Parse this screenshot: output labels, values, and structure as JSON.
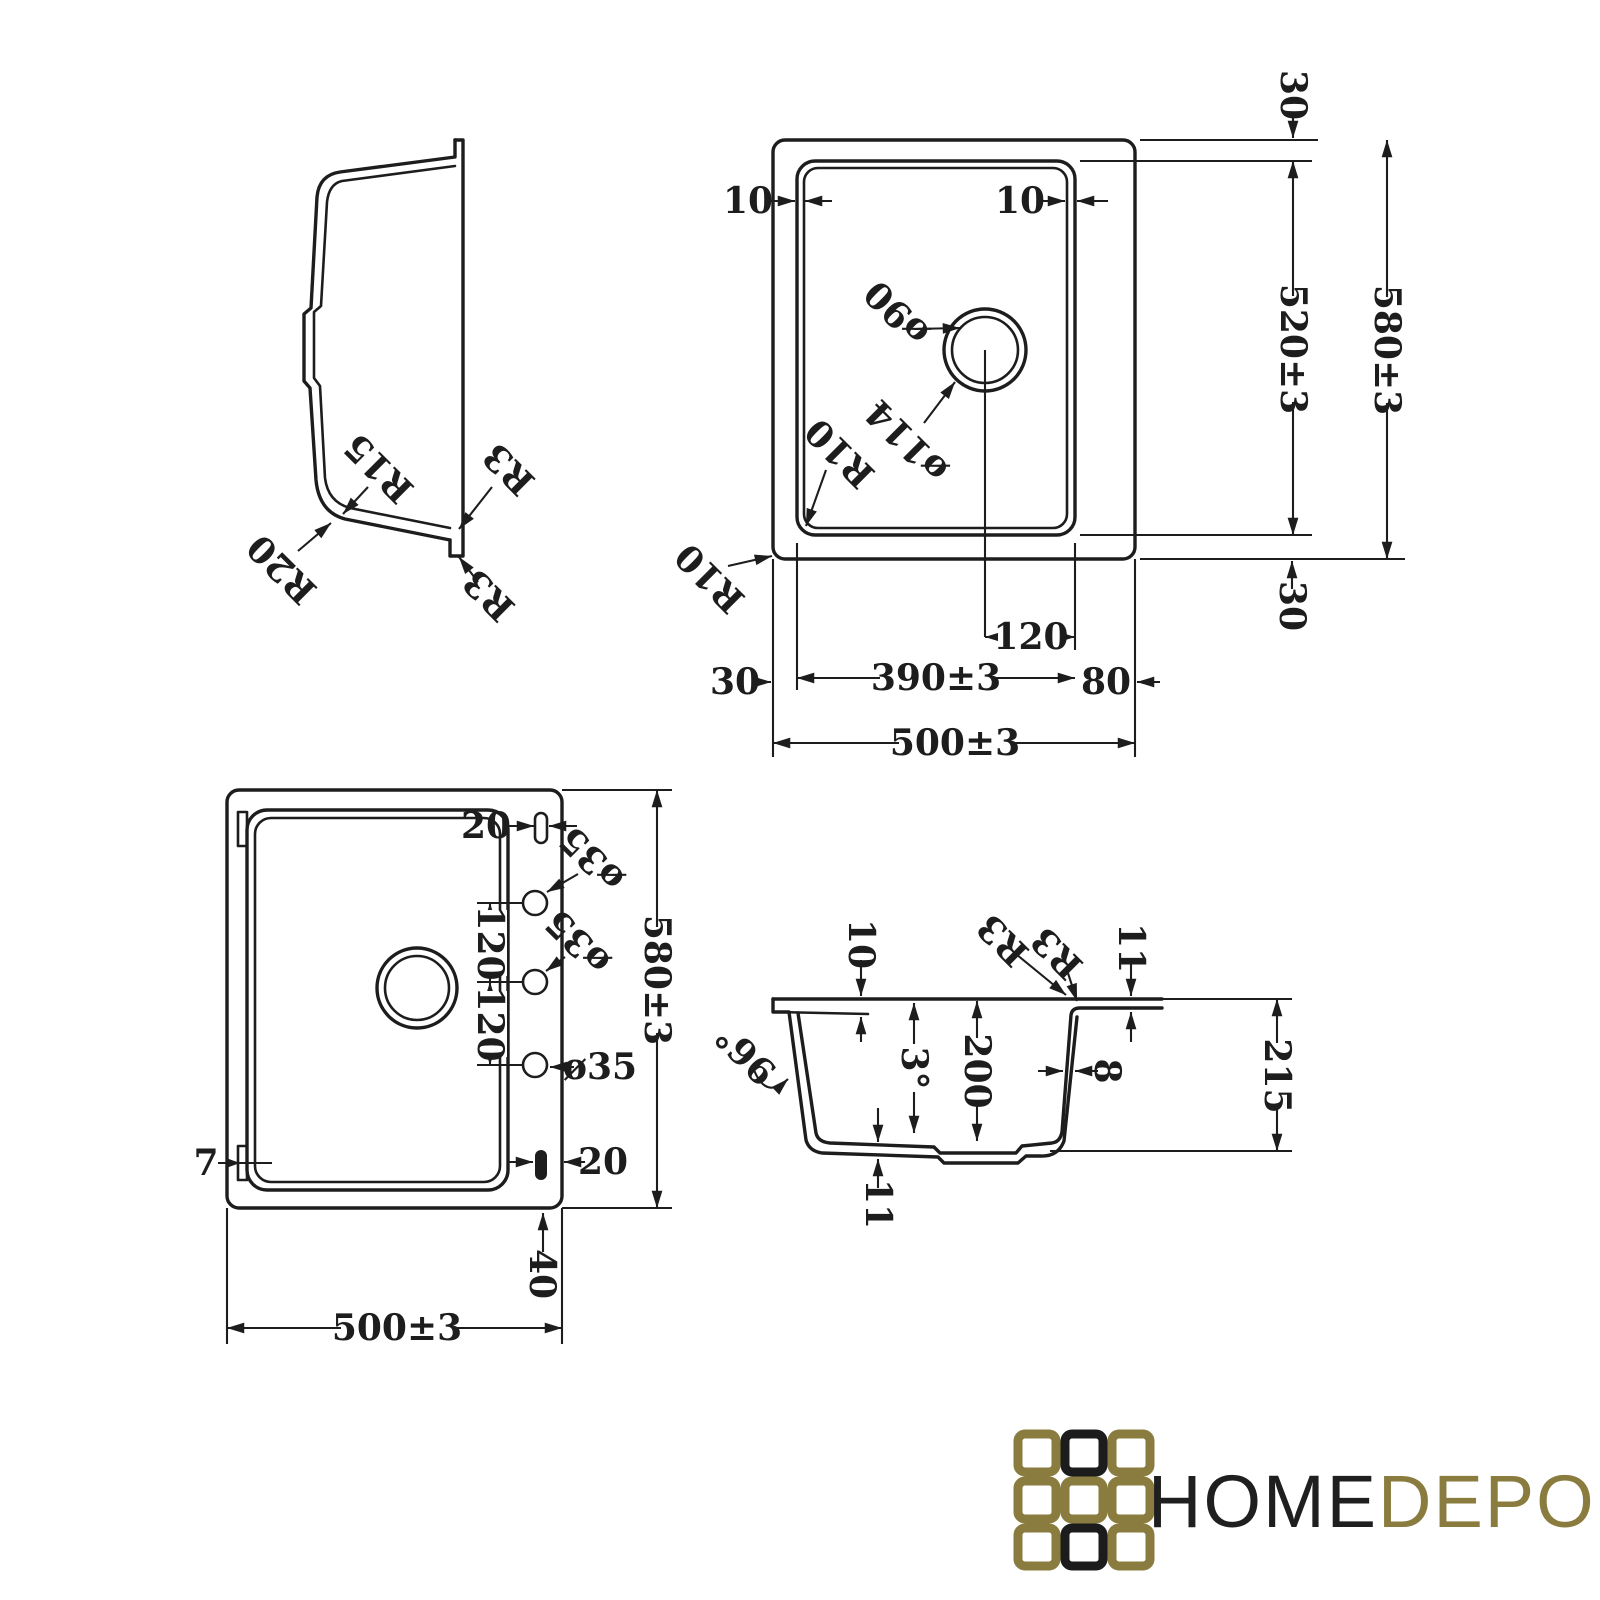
{
  "title": "Kitchen sink technical drawing",
  "palette": {
    "ink": "#1d1d1d",
    "background": "#ffffff"
  },
  "brand": {
    "name_primary": "HOME",
    "name_secondary": "DEPO",
    "color_primary": "#1f1f1f",
    "color_secondary": "#8a7c3f",
    "grid_pattern": [
      [
        "gold",
        "black",
        "gold"
      ],
      [
        "gold",
        "gold",
        "gold"
      ],
      [
        "gold",
        "black",
        "gold"
      ]
    ]
  },
  "views": {
    "side_profile": {
      "labels": {
        "r15": "R15",
        "r20": "R20",
        "r3_upper": "R3",
        "r3_lower": "R3"
      }
    },
    "top_plan": {
      "labels": {
        "wall_left": "10",
        "wall_right": "10",
        "drain_inner_dia": "ø90",
        "drain_outer_dia": "ø114",
        "corner_radius_inner": "R10",
        "corner_radius_outer": "R10",
        "edge_top": "30",
        "edge_bottom": "30",
        "edge_left": "30",
        "bowl_length": "520±3",
        "overall_length": "580±3",
        "drain_offset": "120",
        "bowl_width": "390±3",
        "edge_right": "80",
        "overall_width": "500±3"
      }
    },
    "bottom_plan": {
      "labels": {
        "slot_top": "20",
        "slot_bottom": "20",
        "hole_top_dia": "ø35",
        "hole_mid_dia": "ø35",
        "hole_bottom_dia": "ø35",
        "hole_spacing_upper": "120",
        "hole_spacing_lower": "120",
        "clip_tab": "7",
        "overall_length": "580±3",
        "ledge": "40",
        "overall_width": "500±3"
      }
    },
    "cross_section": {
      "labels": {
        "rim_inset": "10",
        "corner_r3_inner": "R3",
        "corner_r3_outer": "R3",
        "rim_thickness_right": "11",
        "outer_wall_angle": "96°",
        "draft_angle": "3°",
        "bowl_depth": "200",
        "wall_thickness": "8",
        "overall_height": "215",
        "bottom_thickness": "11"
      }
    }
  }
}
